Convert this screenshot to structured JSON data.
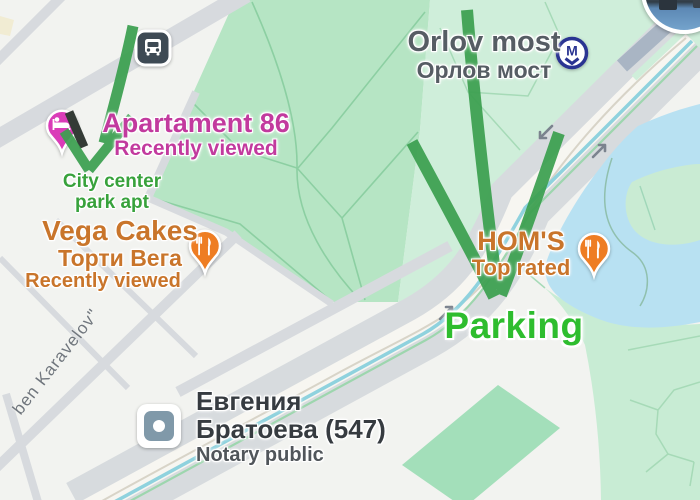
{
  "annotations": {
    "note_line1": "City center",
    "note_line2": "park apt",
    "parking_label": "Parking",
    "arrow_color": "#3ca050"
  },
  "places": {
    "apartament": {
      "name": "Apartament 86",
      "status": "Recently viewed"
    },
    "vega": {
      "name": "Vega Cakes",
      "alt_name": "Торти Вега",
      "status": "Recently viewed"
    },
    "orlov": {
      "name": "Orlov most",
      "alt_name": "Орлов мост"
    },
    "homs": {
      "name": "HOM'S",
      "status": "Top rated"
    },
    "notary": {
      "name_line1": "Евгения",
      "name_line2": "Братоева (547)",
      "category": "Notary public"
    },
    "street": {
      "name": "ben Karavelov\""
    }
  },
  "icons": {
    "bus": "bus-stop-icon",
    "metro": "metro-station-icon",
    "restaurant_pins": "restaurant-pin-icon",
    "lodging": "lodging-pin-icon",
    "notary_poi": "generic-poi-icon",
    "photo": "place-photo-thumbnail"
  },
  "colors": {
    "park_green": "#b6e5c4",
    "pale_park_green": "#cfeeda",
    "water_blue": "#b8e1f2",
    "road_gray": "#d7dbde",
    "annotation_green": "#3ca050",
    "label_magenta": "#c23a9e",
    "label_orange": "#c9752b",
    "parking_green": "#2ebd2e",
    "metro_navy": "#2a3492",
    "pin_orange": "#ee7d23",
    "pin_magenta": "#da3cb8"
  }
}
